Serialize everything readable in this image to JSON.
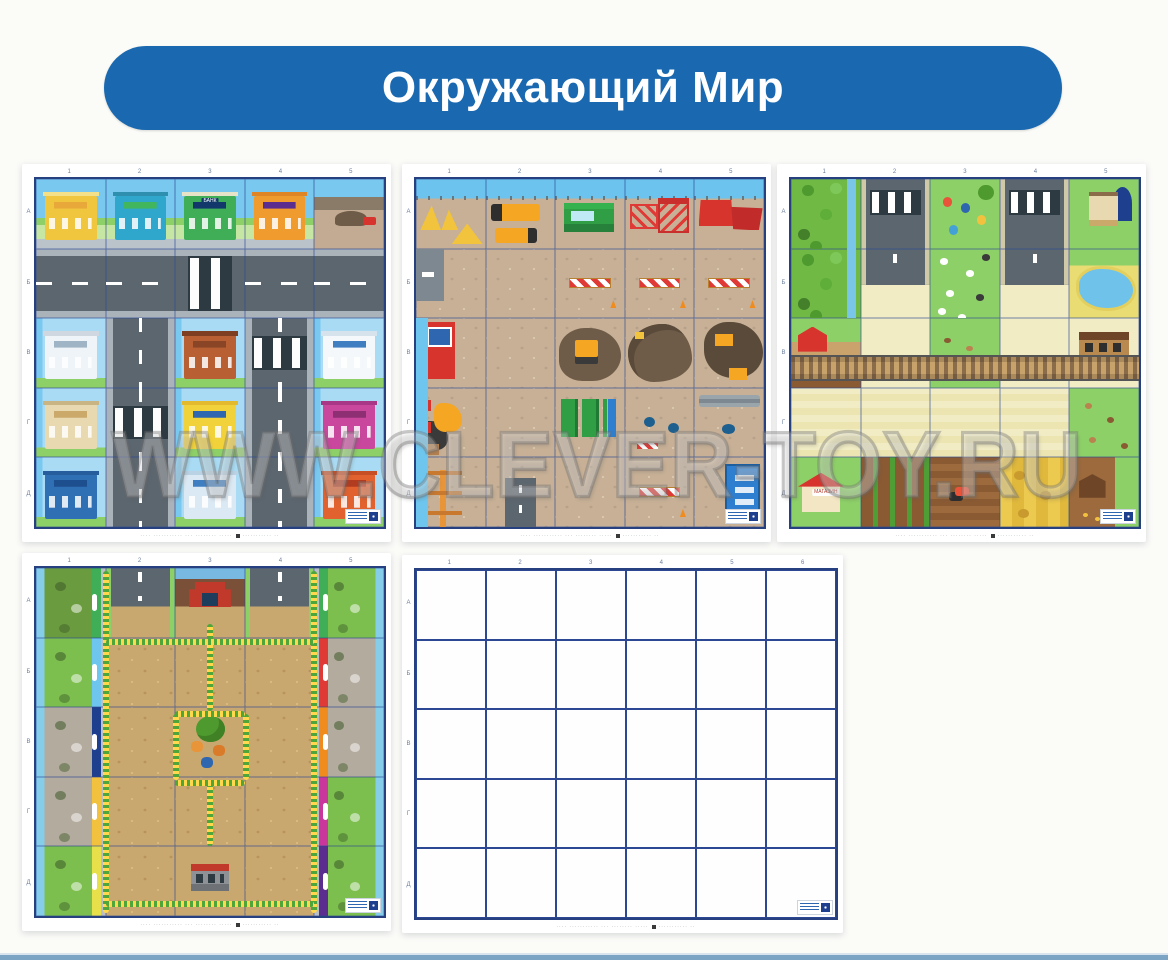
{
  "page": {
    "background": "#fbfbf8",
    "bottom_strip_color": "#7ba3c4"
  },
  "header": {
    "title": "Окружающий Мир",
    "background": "#1a69b0",
    "text_color": "#ffffff"
  },
  "watermark": {
    "text": "WWW.CLEVER-TOY.RU"
  },
  "caption": {
    "left": "···· ··········· ··· ········ ·····",
    "icon": "qr-icon",
    "right": "··········· ··"
  },
  "mats": [
    {
      "id": "city",
      "cols": [
        "1",
        "2",
        "3",
        "4",
        "5"
      ],
      "rows": [
        "А",
        "Б",
        "В",
        "Г",
        "Д"
      ],
      "overlays": [],
      "cells": [
        [
          "city-sky shop-yellow",
          "city-sky shop-teal",
          {
            "c": "city-sky bank-green",
            "label": "БАНК"
          },
          "city-sky clinic-orange",
          "city-sky lot-dirt"
        ],
        [
          "road-h",
          "road-h",
          "road-h xwalk",
          "road-h",
          "road-h"
        ],
        [
          "city-bg bld-school",
          "road-v",
          "city-bg bld-brick",
          "road-v xwalk",
          "city-bg bld-hospital"
        ],
        [
          "city-bg bld-classic",
          "road-v xwalk",
          "city-bg bld-yellow",
          "road-v",
          "city-bg bld-pink"
        ],
        [
          "city-bg bld-blue",
          "road-v",
          "city-bg bld-lightblue",
          "road-v",
          "city-bg bld-fire"
        ]
      ]
    },
    {
      "id": "construction",
      "cols": [
        "1",
        "2",
        "3",
        "4",
        "5"
      ],
      "rows": [
        "А",
        "Б",
        "В",
        "Г",
        "Д"
      ],
      "overlays": [
        "c-edge"
      ],
      "cells": [
        [
          "c-sky c-sand",
          "c-sky c-trucks",
          "c-sky c-cabin",
          "c-sky c-lift",
          "c-sky c-bins"
        ],
        [
          "c-dirt c-wall",
          "c-dirt",
          "c-dirt c-barrier",
          "c-dirt c-barrier",
          "c-dirt c-barrier"
        ],
        [
          "c-dirt c-redunit",
          "c-dirt",
          "c-dirt c-excav",
          "c-dirt c-pit",
          "c-dirt c-excav2"
        ],
        [
          "c-dirt c-mixer",
          "c-dirt",
          "c-dirt c-toilets",
          "c-dirt c-barrels",
          "c-dirt c-pipe"
        ],
        [
          "c-dirt c-crane",
          "c-dirt c-roadstub",
          "c-dirt",
          "c-dirt c-barrier",
          "c-dirt c-container"
        ]
      ]
    },
    {
      "id": "village",
      "cols": [
        "1",
        "2",
        "3",
        "4",
        "5"
      ],
      "rows": [
        "А",
        "Б",
        "В",
        "Г",
        "Д"
      ],
      "overlays": [
        "railroad"
      ],
      "cells": [
        [
          "v-forest",
          "v-road xwalk",
          "v-park",
          "v-road xwalk",
          "v-estate"
        ],
        [
          "v-forest",
          "v-road end",
          "v-sheep",
          "v-road end",
          "v-pond"
        ],
        [
          "v-barn",
          "v-field",
          "v-garden",
          "v-field",
          "v-station"
        ],
        [
          "v-field2",
          "v-field2",
          "v-field2",
          "v-field2",
          "v-meadow"
        ],
        [
          {
            "c": "v-house",
            "label": "МАГАЗИН"
          },
          "v-rows",
          "v-plow",
          "v-wheat",
          "v-coop"
        ]
      ]
    },
    {
      "id": "zoo",
      "cols": [
        "1",
        "2",
        "3",
        "4",
        "5"
      ],
      "rows": [
        "А",
        "Б",
        "В",
        "Г",
        "Д"
      ],
      "overlays": [
        "paths"
      ],
      "cells": [
        [
          "z-encl left wood tag-green",
          "z-roadfade",
          "z-entrance",
          "z-roadfade",
          "z-encl right green tag-green"
        ],
        [
          "z-encl left green tag-lblue",
          "z-dirt",
          "z-dirt",
          "z-dirt",
          "z-encl right rock tag-red"
        ],
        [
          "z-encl left rock tag-blue",
          "z-dirt",
          "z-center",
          "z-dirt",
          "z-encl right rock tag-orange"
        ],
        [
          "z-encl left rock tag-yellow",
          "z-dirt",
          "z-dirt",
          "z-dirt",
          "z-encl right green tag-magenta"
        ],
        [
          "z-encl left green tag-lyellow",
          "z-dirt",
          "z-exit",
          "z-dirt",
          "z-encl right green tag-purple"
        ]
      ]
    },
    {
      "id": "blank",
      "cols": [
        "1",
        "2",
        "3",
        "4",
        "5",
        "6"
      ],
      "rows": [
        "А",
        "Б",
        "В",
        "Г",
        "Д"
      ],
      "overlays": [],
      "cells": [
        [
          "empty",
          "empty",
          "empty",
          "empty",
          "empty",
          "empty"
        ],
        [
          "empty",
          "empty",
          "empty",
          "empty",
          "empty",
          "empty"
        ],
        [
          "empty",
          "empty",
          "empty",
          "empty",
          "empty",
          "empty"
        ],
        [
          "empty",
          "empty",
          "empty",
          "empty",
          "empty",
          "empty"
        ],
        [
          "empty",
          "empty",
          "empty",
          "empty",
          "empty",
          "empty"
        ]
      ]
    }
  ]
}
